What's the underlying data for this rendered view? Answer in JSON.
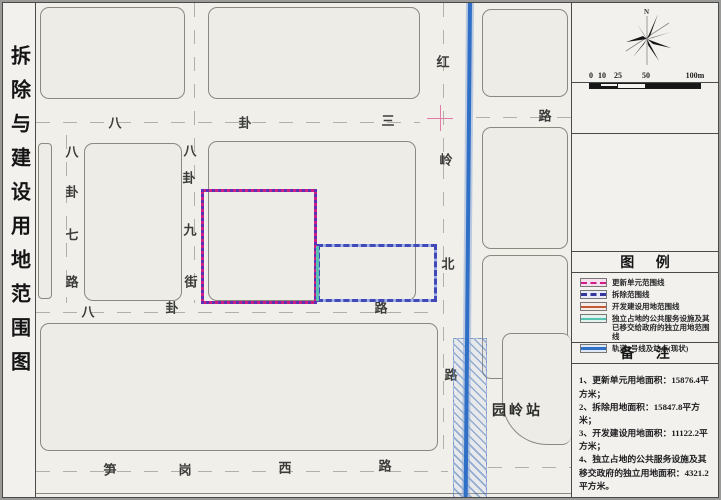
{
  "sidebar": {
    "title": "拆除与建设用地范围图"
  },
  "compass": {
    "north": "N"
  },
  "scale": {
    "labels": [
      {
        "t": "0",
        "x": 2
      },
      {
        "t": "10",
        "x": 13
      },
      {
        "t": "25",
        "x": 29
      },
      {
        "t": "50",
        "x": 57
      },
      {
        "t": "100m",
        "x": 106
      }
    ]
  },
  "map": {
    "station": "园岭站",
    "colors": {
      "update_unit_line": "#cf1d86",
      "demolition_line": "#4348b8",
      "development_line": "#c25a38",
      "independent_land_line": "#57c2b1",
      "metro_line": "#2f6fc6"
    },
    "labels": [
      {
        "t": "八",
        "x": 79,
        "y": 119
      },
      {
        "t": "卦",
        "x": 209,
        "y": 119
      },
      {
        "t": "三",
        "x": 352,
        "y": 117
      },
      {
        "t": "路",
        "x": 509,
        "y": 112
      },
      {
        "t": "八",
        "x": 36,
        "y": 148
      },
      {
        "t": "卦",
        "x": 36,
        "y": 188
      },
      {
        "t": "七",
        "x": 36,
        "y": 231
      },
      {
        "t": "路",
        "x": 36,
        "y": 278
      },
      {
        "t": "八",
        "x": 154,
        "y": 147
      },
      {
        "t": "卦",
        "x": 153,
        "y": 174
      },
      {
        "t": "九",
        "x": 154,
        "y": 226
      },
      {
        "t": "街",
        "x": 155,
        "y": 278
      },
      {
        "t": "红",
        "x": 407,
        "y": 58
      },
      {
        "t": "岭",
        "x": 410,
        "y": 156
      },
      {
        "t": "北",
        "x": 412,
        "y": 260
      },
      {
        "t": "路",
        "x": 415,
        "y": 371
      },
      {
        "t": "八",
        "x": 52,
        "y": 308
      },
      {
        "t": "卦",
        "x": 136,
        "y": 304
      },
      {
        "t": "路",
        "x": 345,
        "y": 304
      },
      {
        "t": "笋",
        "x": 74,
        "y": 466
      },
      {
        "t": "岗",
        "x": 149,
        "y": 466
      },
      {
        "t": "西",
        "x": 249,
        "y": 464
      },
      {
        "t": "路",
        "x": 349,
        "y": 462
      }
    ]
  },
  "legend": {
    "header": "图 例",
    "items": [
      {
        "label": "更新单元范围线",
        "line_style": "dashed",
        "line_color": "#cf1d86",
        "bg": "#f6e0ee",
        "thick": 2
      },
      {
        "label": "拆除范围线",
        "line_style": "dashed",
        "line_color": "#34389c",
        "bg": "#e9ebf6",
        "thick": 3
      },
      {
        "label": "开发建设用地范围线",
        "line_style": "solid",
        "line_color": "#c25a38",
        "bg": "#f6ece5",
        "thick": 2
      },
      {
        "label": "独立占地的公共服务设施及其已移交给政府的独立用地范围线",
        "line_style": "solid",
        "line_color": "#57c2b1",
        "bg": "#e2f3ee",
        "thick": 2
      },
      {
        "label": "轨道9号线及站点(现状)",
        "line_style": "solid",
        "line_color": "#2f6fc6",
        "bg": "#dfe9f6",
        "thick": 3
      }
    ]
  },
  "notes": {
    "header": "备 注",
    "lines": [
      "1、更新单元用地面积：15876.4平方米；",
      "2、拆除用地面积：15847.8平方米；",
      "3、开发建设用地面积：11122.2平方米；",
      "4、独立占地的公共服务设施及其移交政府的独立用地面积：4321.2平方米。"
    ]
  }
}
